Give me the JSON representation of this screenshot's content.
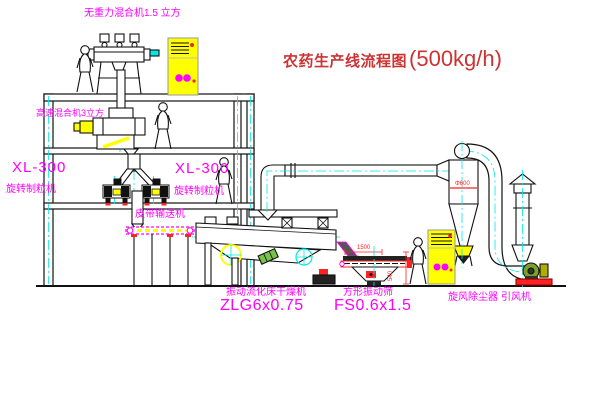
{
  "title": {
    "name": "农药生产线流程图",
    "capacity": "(500kg/h)"
  },
  "equipment_labels": {
    "gravity_mixer": "无重力混合机1.5 立方",
    "high_speed_mixer": "高速混合机3立方",
    "granulator_left_model": "XL-300",
    "granulator_left_name": "旋转制粒机",
    "granulator_right_model": "XL-300",
    "granulator_right_name": "旋转制粒机",
    "belt_conveyor": "皮带输送机",
    "dryer_name": "振动流化床干燥机",
    "dryer_model": "ZLG6x0.75",
    "screen_name": "方形振动筛",
    "screen_model": "FS0.6x1.5",
    "cyclone_name": "旋风除尘器",
    "fan_name": "引风机"
  },
  "dimensions": {
    "cyclone_diameter": "Φ600",
    "screen_length": "1500",
    "screen_height": "540"
  },
  "colors": {
    "line": "#111111",
    "label_text": "#ff00ff",
    "title_text": "#cc3333",
    "dimension_text": "#ff2222",
    "cabinet_fill": "#ffff00",
    "centerline": "#00e8e8",
    "background": "#ffffff"
  }
}
